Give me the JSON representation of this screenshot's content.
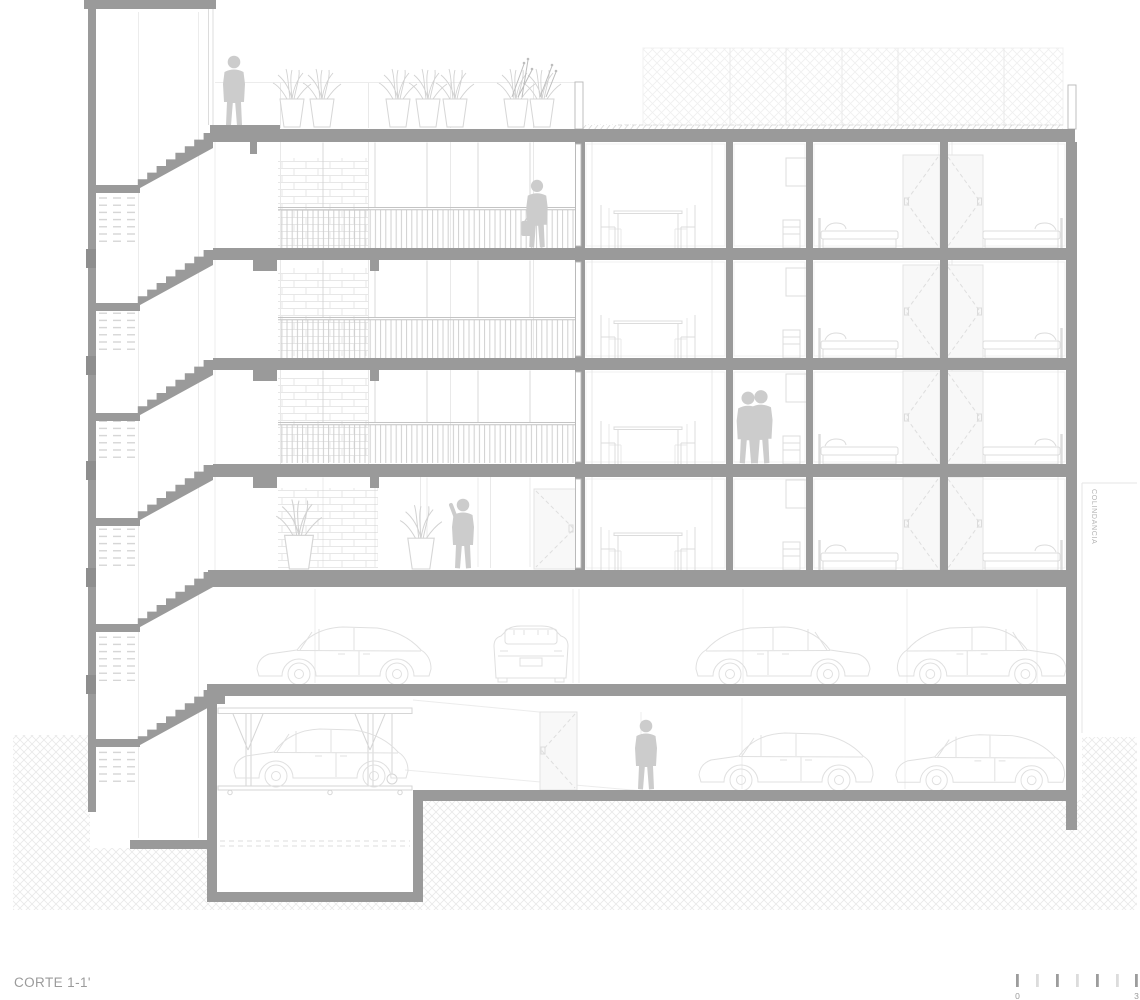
{
  "labels": {
    "title": "CORTE 1-1'",
    "boundary": "COLINDANCIA"
  },
  "scale_bar": {
    "start": "0",
    "end": "3",
    "tick_count": 7
  },
  "figures": {
    "people": [
      "person-on-roof",
      "person-on-walkway-with-briefcase",
      "couple-in-room",
      "person-on-ground-floor",
      "person-in-basement"
    ],
    "vehicles": [
      "car-side-parking",
      "car-rear-parking",
      "car-side-parking-right-1",
      "car-side-parking-right-2",
      "car-on-lift",
      "car-side-basement-1",
      "car-side-basement-2"
    ],
    "plants": [
      "roof-planter-cluster-1",
      "roof-planter-cluster-2",
      "roof-planter-cluster-3",
      "ground-floor-planter-1",
      "ground-floor-planter-2"
    ]
  },
  "colors": {
    "structure": "#9a9a9a",
    "block": "#8e8e8e",
    "outline": "#dcdcdc",
    "silhouette": "#cccccc",
    "hatch": "#e9e9e9",
    "text": "#9b9b9b",
    "text-light": "#b2b2b2"
  }
}
